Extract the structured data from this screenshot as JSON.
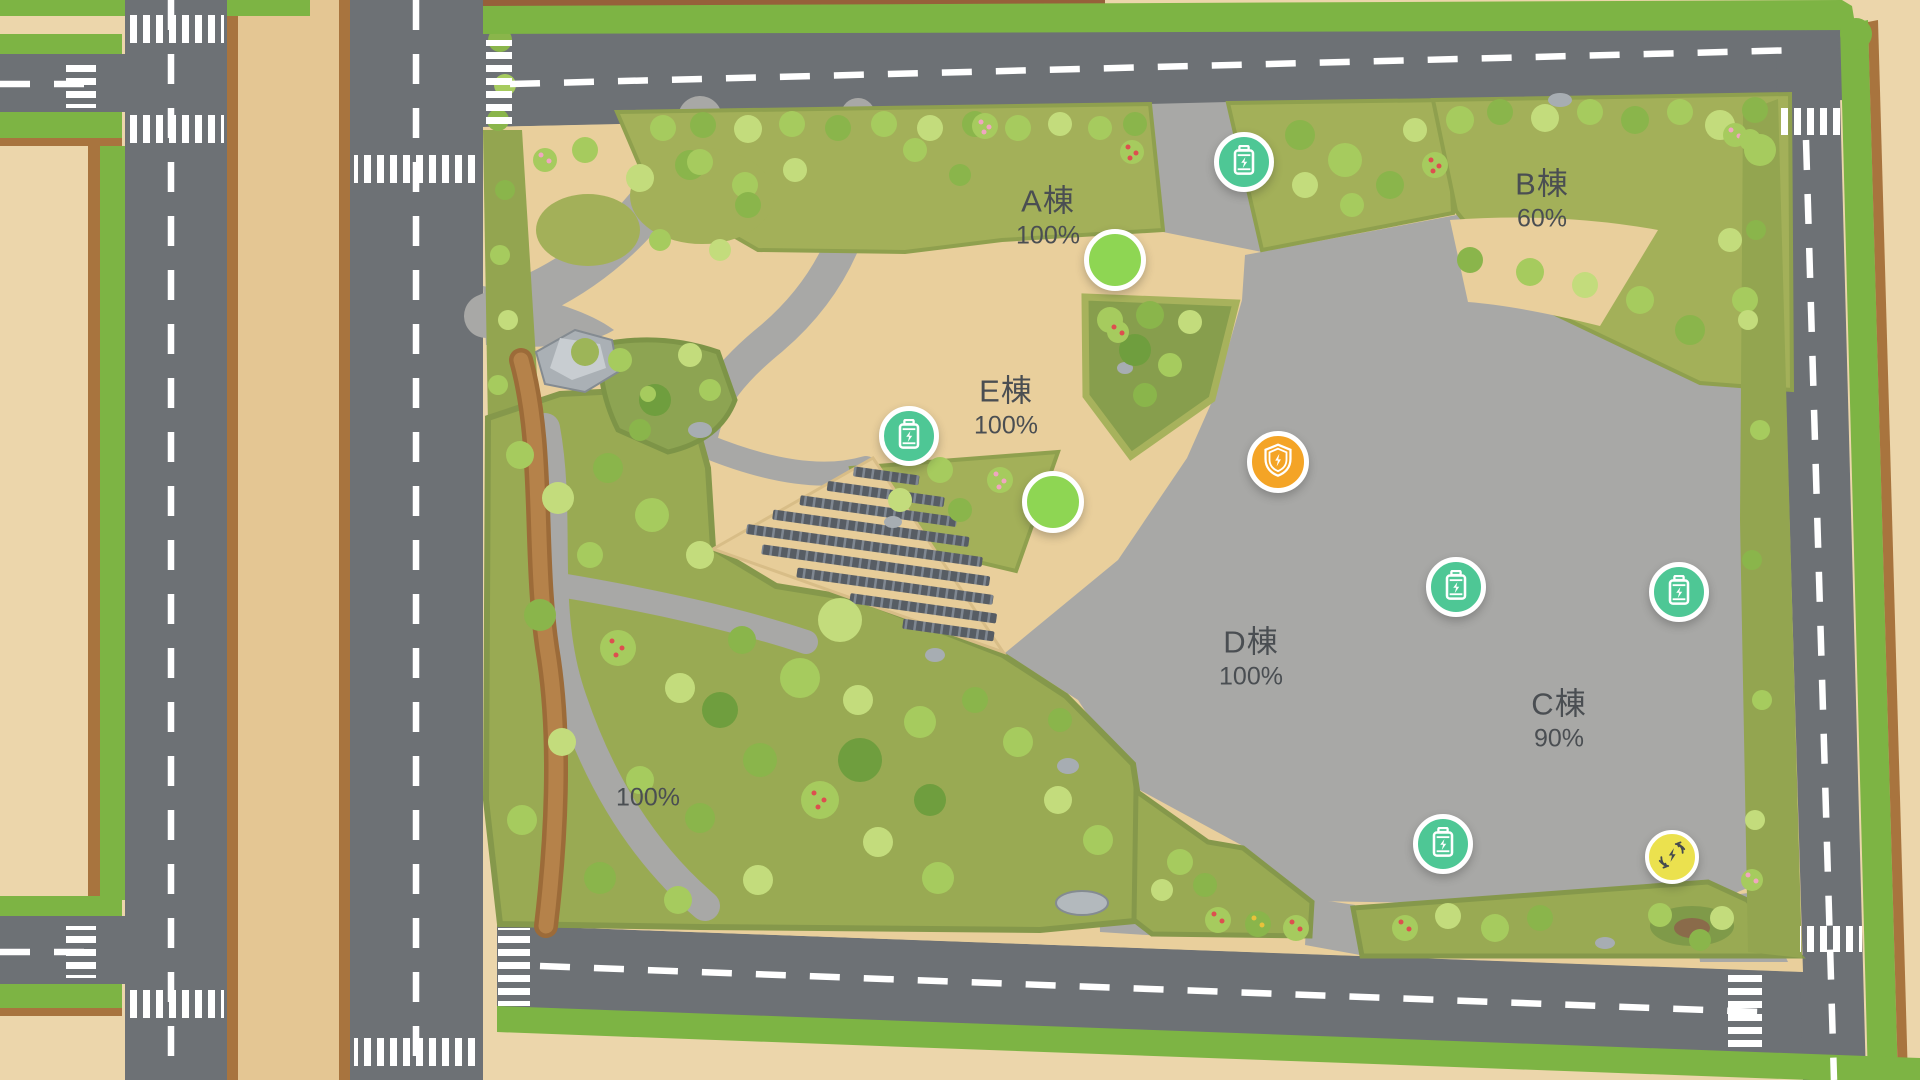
{
  "map": {
    "zone_label": {
      "percent": "100%"
    },
    "buildings": [
      {
        "id": "A",
        "name": "A棟",
        "percent": "100%"
      },
      {
        "id": "B",
        "name": "B棟",
        "percent": "60%"
      },
      {
        "id": "E",
        "name": "E棟",
        "percent": "100%"
      },
      {
        "id": "D",
        "name": "D棟",
        "percent": "100%"
      },
      {
        "id": "C",
        "name": "C棟",
        "percent": "90%"
      }
    ],
    "markers": [
      {
        "id": "battery-a",
        "type": "battery-icon"
      },
      {
        "id": "status-a",
        "type": "status-dot"
      },
      {
        "id": "battery-e",
        "type": "battery-icon"
      },
      {
        "id": "status-e",
        "type": "status-dot"
      },
      {
        "id": "security-shield",
        "type": "shield-energy-icon"
      },
      {
        "id": "battery-d-west",
        "type": "battery-icon"
      },
      {
        "id": "battery-d-east",
        "type": "battery-icon"
      },
      {
        "id": "battery-c",
        "type": "battery-icon"
      },
      {
        "id": "energy-recycle",
        "type": "energy-recycle-icon"
      }
    ],
    "colors": {
      "road": "#6d7175",
      "plaza": "#a8a8a6",
      "ground": "#e9cf9c",
      "lawn": "#a3b059",
      "park": "#99aa53",
      "hedge": "#7db444",
      "battery": "#4ec795",
      "shield": "#f4a426",
      "status": "#8ed653",
      "energy": "#ebe14e",
      "label_text": "#4a4e52"
    }
  }
}
